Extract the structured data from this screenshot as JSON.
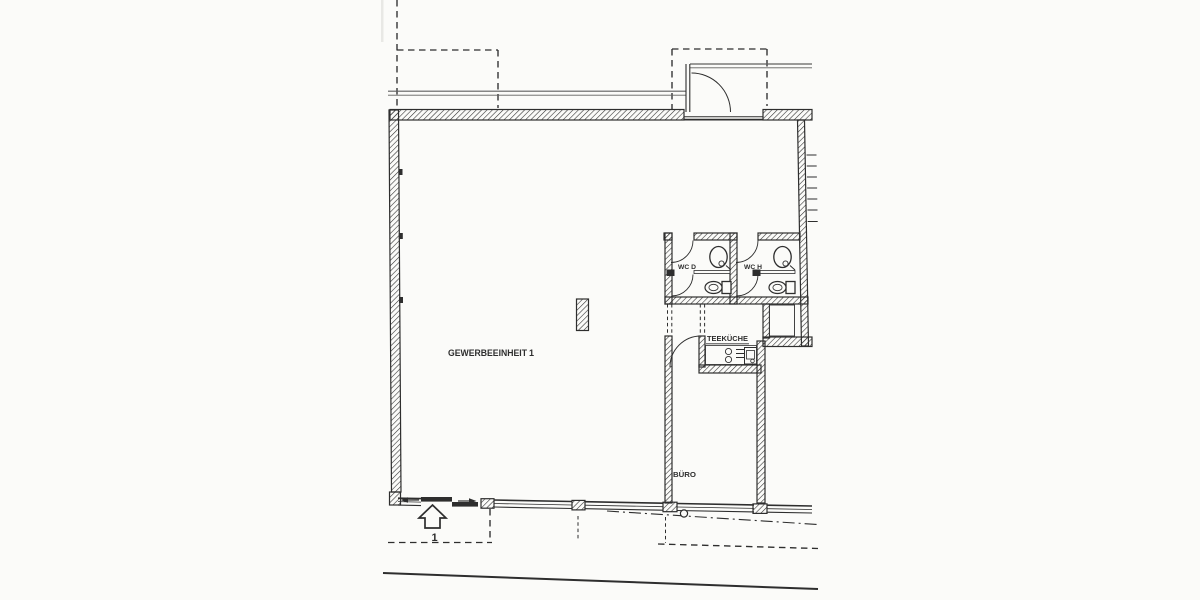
{
  "colors": {
    "ink": "#2e2e2e",
    "paper": "#fbfbf9",
    "light_line": "#5f5f5f"
  },
  "labels": {
    "unit_name": "GEWERBEEINHEIT",
    "unit_number": "1",
    "wc_d": "WC D",
    "wc_h": "WC H",
    "kitchen": "TEEKÜCHE",
    "office": "BÜRO",
    "entrance_number": "1"
  }
}
